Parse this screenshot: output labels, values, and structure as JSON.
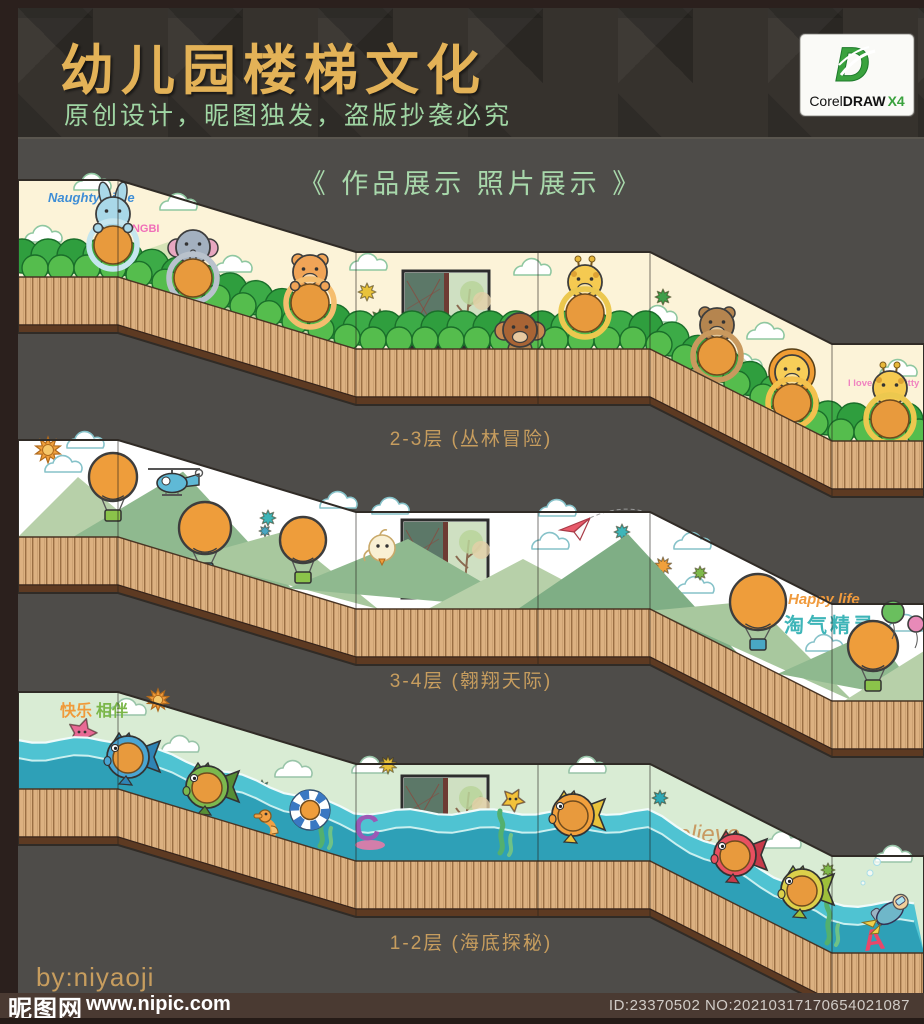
{
  "header": {
    "title": "幼儿园楼梯文化",
    "subtitle": "原创设计，昵图独发，盗版抄袭必究",
    "logo": {
      "corel": "Corel",
      "draw": "DRAW",
      "version": "X4"
    }
  },
  "section": {
    "heading": "《 作品展示  照片展示 》"
  },
  "murals": [
    {
      "name": "jungle-adventure",
      "floors": "2-3层",
      "theme": "丛林冒险",
      "caption": "2-3层 (丛林冒险)",
      "wall_color": "#fcf3d8",
      "texts": {
        "brand": "Naughty Little",
        "brand_sub": "ANGBI",
        "kitty": "I love hello kitty"
      },
      "motifs": [
        "rabbit",
        "elephant",
        "hamster",
        "monkey",
        "giraffe",
        "bear",
        "lion",
        "bushes",
        "clouds",
        "flowers",
        "photo-window"
      ]
    },
    {
      "name": "soaring-sky",
      "floors": "3-4层",
      "theme": "翱翔天际",
      "caption": "3-4层 (翱翔天际)",
      "wall_color": "#ffffff",
      "texts": {
        "happy": "Happy life",
        "sprite": "淘气精灵"
      },
      "motifs": [
        "hot-air-balloon",
        "helicopter",
        "chick",
        "paper-plane",
        "mountains",
        "sun",
        "clouds",
        "photo-window"
      ]
    },
    {
      "name": "undersea-quest",
      "floors": "1-2层",
      "theme": "海底探秘",
      "caption": "1-2层 (海底探秘)",
      "wall_color": "#d9ecd4",
      "texts": {
        "joy_a": "快乐",
        "joy_b": "相伴",
        "believe": "believe",
        "letter_c": "C",
        "letter_a": "A"
      },
      "motifs": [
        "fish",
        "starfish",
        "seahorse",
        "lifebuoy",
        "diver",
        "seaweed",
        "waves",
        "clouds",
        "photo-window"
      ]
    }
  ],
  "byline": "by:niyaoji",
  "footer": {
    "site_name": "昵图网",
    "site_url": "www.nipic.com",
    "id_text": "ID:23370502 NO:20210317170654021087"
  },
  "colors": {
    "frame": "#2b201d",
    "body_bg": "#4e4c49",
    "header_bg": "#36322d",
    "title_gold": "#e3b257",
    "subtitle_green": "#a0d6a4",
    "caption_gold": "#c79d5e",
    "fence_tan": "#dcb181",
    "fence_base": "#5d3a22",
    "porthole_orange": "#e89a3d",
    "bush_green": "#2f9e3e",
    "water_teal": "#2a9cb4",
    "footer_bar": "#4a3a32"
  }
}
